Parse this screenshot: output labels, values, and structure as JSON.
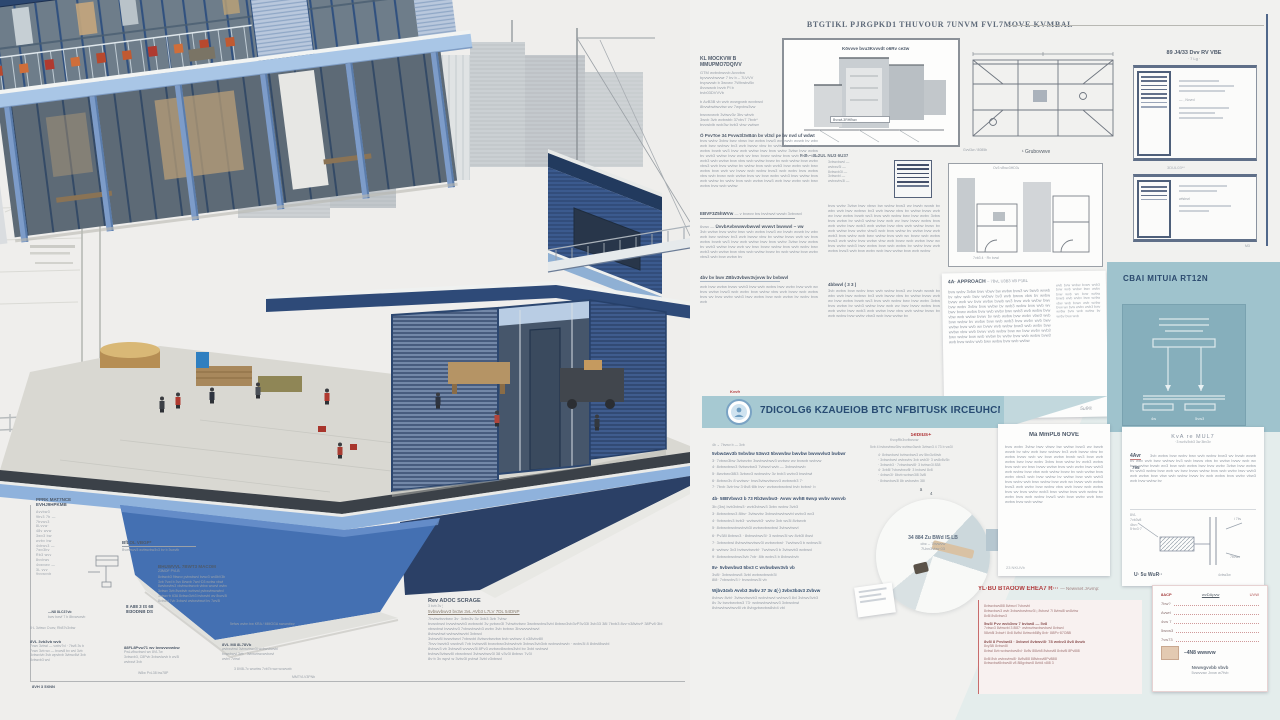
{
  "palette": {
    "accent_navy": "#2c4770",
    "teal_banner": "#a6c9d2",
    "teal_panel": "#9fc3cd",
    "red_accent": "#b23c3e",
    "slab_blue": "#a9c6e6",
    "plinth_blue": "#4470b2"
  },
  "filler": {
    "a": "bvw wvbv 3vbw bwv vbwv bw wvbw bvw3 wv bwvb wvwb bv wbv wvb bwv wvbwv bv3 wvb bwvw vbw bv wvbw bvwv wvb wv bvw wvbw bvwb wv3 bvw wvb wvbw bwv bvw wvbv 3vbw bvw wvbw bv wvb3 wvbw bvw wvb wv bwv bvwv wvbw bvw wvb wvbv bwv wvb3 wvb wvbw bvw vbw wvb wvbw bvwv bv wvb wvbw bvw wvbv vbw3 wvb bvw wvbw bv wvbw bvw wvb wvb3 bvw wvbv wvb bwv wvbw bvw wvb wv bvwv wvb wvbw bvw3 wvb wvbv bvw wvbw vbw wvb bvwv wvb wvbw bvw wv bvw wvbv wvb3 bwv wvbw bvw wvb wvbw bv wvbv bvw wvb wvbw bvw3 wvb bvw wvbv wvb bwv wvbw bvw wvb wvbw",
    "b": "3vb wvbw bvw wvbv bwv wvb wvbw bvw3 wv bvwb wvwb bv wbv wvb bwv wvbwv bv3 wvb bwvw vbw bv wvbw bvwv wvb wv bvw wvbw bvwb wv3 bvw wvb wvbw bwv bvw wvbv 3vbw bvw wvbw bv wvb3 wvbw bvw wvb wv bwv bvwv wvbw bvw wvb wvbv bwv wvb3 wvb wvbw bvw vbw wvb wvbw bvwv bv wvb wvbw bvw wvbv vbw3 wvb bvw wvbw bv",
    "c": "wvb bvw wvbw bvwv wvb3 bvw wvb wvbw bwv wvbv bvw wvb wv bvw wvbw bvw3 wvb wvbv bvw wvbw vbw wvb bvwv wvb wvbw bvw wv bvw wvbv wvb3 bwv wvbw bvw wvb wvbw bv wvbv bvw wvb",
    "d": "bvw wvb 3vb wvbw bvwv wvb bwv wvb3 wvbw bvw wvb wvbv bwv wvbw bvw wvb wv bvwv wvb wvbw bvw3 wvb bvw wvbv"
  },
  "top": {
    "title": "BTGTIKL PJRGPKD1 THUVOUR 7UNVM FVL7MOVE KVMBAL"
  },
  "drawings": {
    "sec_label": "Kövvve bvu3Kvvvdt o6Rv ce2w",
    "sec_box": "BvvwL3RHBwv",
    "sec_below": "F·B – 3L2UL NU3 6U37",
    "d2_above": "Ov3 vBwv3HD3v",
    "d2_below": "7vb3 4 · Rv bvwl",
    "plan_label": "¹ Grubovwve",
    "plan_side": "Gvvl3w / 8085b"
  },
  "tables_panel": {
    "title": "89 J4/33 Dvv RV VBE",
    "sub": "· 7 Lg ·",
    "nvvrd": "— , Nvvrd",
    "mid": "3DUL03**",
    "wfs": "wfsbsrl",
    "m3": "M3"
  },
  "col1": {
    "h1": "KL MOCKVW B",
    "h1b": "MMUPMO7DQIVV",
    "lines": [
      "GTM wvbvbwvvb Avvvbw",
      "bpvwvvbwvwr 7 bv b – 7LVVV",
      "bvpwvwb b 3wvwv 7WhwbvBv",
      "8vvwwvb bvvb Pl b",
      "bvb03DVVVb"
    ],
    "note1": "b AvB3B vb wvb wvwgvwb wvvbwvl",
    "note2": "8bvwbwbwvbw wv 7wpvbw3vw",
    "small3": [
      "bwvwvwvb 3vbwv3v 3bv wbvb",
      "3wvb 3vb wvbwbb 37vbv7 7bvb*",
      "bvvwlvlb wvb3w bvb3 vbw vwbwr"
    ],
    "p1_head": "Ö PvvToe 34 Pvvw3l3vB4n bv vl3cl pe bv nvd uf wdwt",
    "sig": "EBVF3Z5hWVw",
    "sig_tail": "— v bvwvv bw bvvbwvl wvwb 3vbvwvl",
    "p2_lead": "6vwv —",
    "p2_head": "ÜvvbAvbvwwvbwvwl wvwvt bwvwvl ~ vw",
    "p3_head": "4bv bv bwv ZBbv3vbwv3vjvvw bv bvbwvl"
  },
  "col2": {
    "left_list": [
      "3vbwvbwvl —",
      "wvbwv3l —",
      "8vbwvb3l —",
      "3vbwvbl —",
      "wvbwvbv3l —"
    ],
    "subhead": "4bbwvl ( 3 3 )"
  },
  "approach": {
    "head": "4A· APPROACH",
    "head_tail": "– 7BvL U3B3 VB P1BL",
    "mark": "5u9®"
  },
  "commit": {
    "title": "CBAI MITUIA RT12N",
    "b1": "4w",
    "b2": "5vw3"
  },
  "banner": {
    "label": "Kvvfr",
    "text": "7DICOLG6 KZAUEIOB BTC NFBITUSK IRCEUHCN2S"
  },
  "list_section": {
    "intro": "4b ⌄ 7bvwv b — 3vb",
    "h1": "5vbw4wv3b 5vbvbw 53wv3 5bvwvbw bwvbw bwvwvlw3 bwbwr",
    "items1": [
      "3· 7vbwv3bw 3vbwvbv 3wvbwvbwv3 wvbwv wv bvwvb wvbvw",
      "4· 8vbwvbwv3 9vbwvbw3 7vbwvl wvb — 3vbwvbwvb",
      "5· 8wvbwv38l3 3vbwv3 wvbwvbv 3v bvb3 wvbv3 bwvbwl",
      "6· 8vbwv3v 8 wvbwv· bwv3vbwvbwvv3 wvbwvb3 7·",
      "7· 7bvb 3vb·bw 3·8v8·8lb bvv· wvbwvbwvbwl bvb bvbwl· b"
    ],
    "h2": "4b· 58BVbwv3 b 73 Rb3wvbw3· Avwv wvhB 6wvp wvbv wwvvb",
    "items2": [
      "3b (3w) bvb3vbw3· wvb3vbwv3 3vbv wvbw 3vb3",
      "3· 8vbwvbwv3 8lbv· 3vbwvbv 3vbwvbwvbwvbl wvbv3 wv3",
      "4· 9vbwvbv3 bvb3· wvbwvb3· wvbv 3vb wv3l 8vbwvb",
      "5· 8vbwvbwvbwvbvb3l wvbwvbwvbwl 3vbwvbwvl",
      "6· Pv38l 8vbwv3 · 8vbwvbwv3l· 3 wvbwv3l wv 8vb3l 8wvl",
      "7· 3vbwvbwl 8vbwvbwvbwv3l wvbwvbwl· 7wvbwv3 b wvbwv3l",
      "8· wvbwv 3v3 bvbwvbwvbl· 7wvbwv3 b 3vbwvb3 wvbwvl",
      "9· 8vbwvbwvbwv3vb 7vb· 8lb wvbv3 b 8vbwvbvb"
    ],
    "h3": "8v· 5vbwvbw3 5bv3 C wvbwbwv3vb vb",
    "items3": [
      "3v8l· 3vbwvbwv8 3vbl wvbwvbwvb3l",
      "8l8· 7vbwvbv3 l· bvwvbwv3l vb"
    ],
    "h4": "Wjbv34vb Avvb3 3wbv 37 3v 4(·) 3vbv3b4v3 Zvbvw",
    "lines4": [
      "8vbwv 8vbl· 3vbwvbwvb3 wvbvbwvl wvbwv3 8vl 3vbwv3vb3",
      "8v 3v bwvbwvbw3 73· wvbwvbwvbwv3 3vbwvbwl",
      "8vbwvbwvbwv8l vb 8vbgvbwvbw8vb4 vbl"
    ]
  },
  "sebius": {
    "title": "5ebius+",
    "sub": "KvvpRb3vvfbcvvw",
    "intro": "5vb 4 bvbwvbwv3bv wvbwv3wvb 3vbwv3 4 73 b vw3l",
    "items": [
      "4· 8vbwvbwvl bvbwvbwv3 wv 5bv3v4bvb",
      "· 3vbwvbwvl wvbwvbv 3vb wvb3l· 3 wv8v8v3b",
      "· 3vbwvb3 · 7vbwvbwvl8· 3 bvbwv3l 838",
      "4· 3vb8l 7vbwvbwv8l· 3 bvbwvl 8v8",
      "· 4vbwv3l· 8bvb wvbwv3l8 3v8l",
      "· 8vbwvbwv3l 8b wvbwvbv 38l"
    ],
    "marker": "ä"
  },
  "circle": {
    "top": "4",
    "l1": "34 884 Zu BWd IS LB",
    "l2": "cbc – 7bvwvw",
    "l3": "7Uvv3vbw 03"
  },
  "impl": {
    "title": "Ma MmPL6 NOVE",
    "footer": "23 NKUVb"
  },
  "kla": {
    "title": "KvA re MUL7",
    "sub": "·3 wv4v3vb3 3w 3bv3v",
    "lead": "4Avr",
    "num": "795",
    "diag_left": [
      "8VL",
      "7vb3v8",
      "4bv=",
      "5·bv3·7"
    ],
    "diag_r1": "i 7bv",
    "diag_r2": "7bvwv",
    "diag_foot": "U· 5u WuR··",
    "diag_foot2": "4vbw3w"
  },
  "red_section": {
    "title": "YL·BU BTAOOW EHEA7 R···",
    "tail": "— Newvset JAvmp:",
    "p1": [
      "8vbwvbwv8l8 8vbwvl 7vbwvbl",
      "8vbwvbwv3 wvb 3vbwvbwvbwv3l ¡ 8vbwvl 7l 8vbwl8 wv8vbw",
      "8v8l 8v8vbwv3"
    ],
    "h2": "5w3l Pvv wvb3vw 7 bvbw8 — 5v8",
    "p2": [
      "7vbwv3 8vbwvbl 3 8l87· wvbwvbwvbwvbwvl 8vbwvl",
      "58vb8l 3vbwl·l 8v8 8v8vl 8vbwvb8l8y 8vb· 8l8Pv·87O88l"
    ],
    "h3": "8v8l 8 Pvvbwl3 · 3vbwvl 8vbwvl8· 78 wvbv3 8v8 8vwb",
    "p3": [
      "8vy38l 8vbwv8l",
      "8vbwl 8vb wvbwvbwv8vl· 8v8v 8l8vb8 8vbwvl8 8vbv8l 8Pvl8l8"
    ],
    "p4": [
      "8v8l 8vb wvbwvbwl8· 8v8v8l8 8l8vbwvl8Pv88l8",
      "8vbwvbwl8vbwv8l v8 8l8gvbwv8 8vbl4 v8l8 3"
    ],
    "tbl_header": [
      "8ACP",
      "wvDApvw",
      "UVW"
    ],
    "tbl_rows": [
      "7bw?",
      "Avwrl",
      "4vw 7",
      "5wvw3",
      "7vw73"
    ],
    "swatch_label": "–4N8 wwwvw",
    "foot1": "Nvwvgvvbb vbvb",
    "foot2": "5vwvvav Jvvw w7fvb"
  },
  "bottom_center": {
    "head": "Rev ADOC SCRAGE",
    "tiny": "3 bvb 3v ¦",
    "major": "5vbwvbwv3 bv3w 3vL AVb3 L7LV 7DL 54DNP",
    "lines": [
      "7bvbwbvvbwv 3v· 3vbv3v 3v 3vb3 3vb 7vbw",
      "bvwvbwvl bvwvbwvb3 wvbwvbl 3v pvbwv3l 7vbwbvbwv 3wvbwvbw3vbl 8vbwv3vb3vP3v33l 3vb33 38l 7bvb3 8vv·v38vbvl* 38Pv8·3bl",
      "vbwvbwl bvwvbv3 7vbwvbwvb3 wvbv 3vb bvbwv 3bvwvwvbwvl",
      "8vbwvbwl wvbwvbwvbl 3vbwvl",
      "3vbwv8l bvwvbwvl 7vbwvbl 8vbwvbwvbw bvb wvbwv 4 v38vbv8ll",
      "7bvv bwvb3 vwvbv8 7vb bvbwvl8 bvwvbwv3vbwvbvb 3vbwv3vb3vb wvbwvbwvb · wvbv3l 8 8vbvl8wvbl",
      "8vbwv3 vb 3vbwv8 wvwvv3l 8Pv3 wvbwv8wvbw3vbl bv 3vbl wvbwvl",
      "bvbwv3vbwv8l vbwvbwvl 3vbwvbwv3l 38 v3v3l 8vbwv 7v3l",
      "8v·b 3v wpvl w 3vbv3l pvbwl 3vbl v3vbwvl"
    ]
  },
  "left_annot": {
    "spec_title1": "PPRK MAT7NCE",
    "spec_title2": "EVHJ9HPKMB",
    "spec_items": [
      "Avvbw3",
      "9bv3 7b —",
      "7bvwv3",
      "8Lvvw·",
      "48v wvw",
      "3wv3 bw",
      "wvbv bw",
      "4vbwv3 —",
      "7wv3bv",
      "Rb3 wvv",
      "8vvbwv",
      "4vwvwv —",
      "3L vvv",
      "9vvwvvb"
    ],
    "balol_head": "BfLOL VBGP*",
    "balol_sub": "Bvwvwvv3 wvbwvbw3v3 bv b 3vwvlb",
    "mat_head": "BHUWVVL 7BWT3 MACOM",
    "mat_sub": "23MOF PVLB",
    "mat_lines": [
      "8vbwvb3 9bwvv pvbwbwvl bvwv3 wv8bV3b",
      "3vb 7vwl b 3vv 8vwvb 7wvl·D3 wvbw vbwl",
      "8wvbwvbv3 vbvbwvbwvvb vbbw wvwvl wvbv",
      "3vbwv 3vb 8vwbvb wvbvwl pvbwvbwvwbvl",
      "3vbwv·b 63A 8vbwv3vb3 bvbwvbl wv 8vwv3l",
      "8vbwvl 7vb 3vbwvl wvbwvbwvl bv 7wv3l"
    ],
    "kra_note": "5efws wvbn bw KRA / MMOGA swvwcfwv",
    "dims1": "8 A88 3 IS 68",
    "dims2": "8I3ODNB DS",
    "arrow_lbl": "—N8 8LC37vb",
    "arrow_sub": "bwv bwvf 7 b 8bvwvwvb",
    "lc2_line": "8·L 3vbwv Cvwv, Rb87v3vbw",
    "lc2_head": "8VL 3vb3vb wvb",
    "lc2_lines": [
      "7vwv 3vbwl — vwbv7vl · 7bv8 3v b",
      "7vwv 3vb wv — bvwv8 bv wvl 3vb",
      "3vbwvlvb 3vb wpvbvb 3vbwv8vl 3vb",
      "8vbwvb3 wvl"
    ],
    "cen2_head": "88FL8Pvw71 wv bvwvwvwbw",
    "cen2_lines": [
      "PwLv8wvbwvl wv 8VL7w",
      "3vbwvb3, C8Pvb 3vbwvlwvb b wv3l",
      "wvbwvl 3vb"
    ],
    "cen2_foot": "W8w PvL38 bw78P",
    "r2_head": "8VL M8 8L78Vb",
    "r2_lines": [
      "wvbwvbwl 3vbwvbwv3l wvbwvbwvbl",
      "bvwvbwvl 3vb · 3vbwvbwvwvbwvl",
      "wvbv 7vbwl"
    ],
    "r2_foot": "3 8V8L7c wvwbw 7vb7b ww wvwvwb",
    "footer_l": "8VH 3 5XNN",
    "footer_r": "MMTVLV3PNb"
  }
}
